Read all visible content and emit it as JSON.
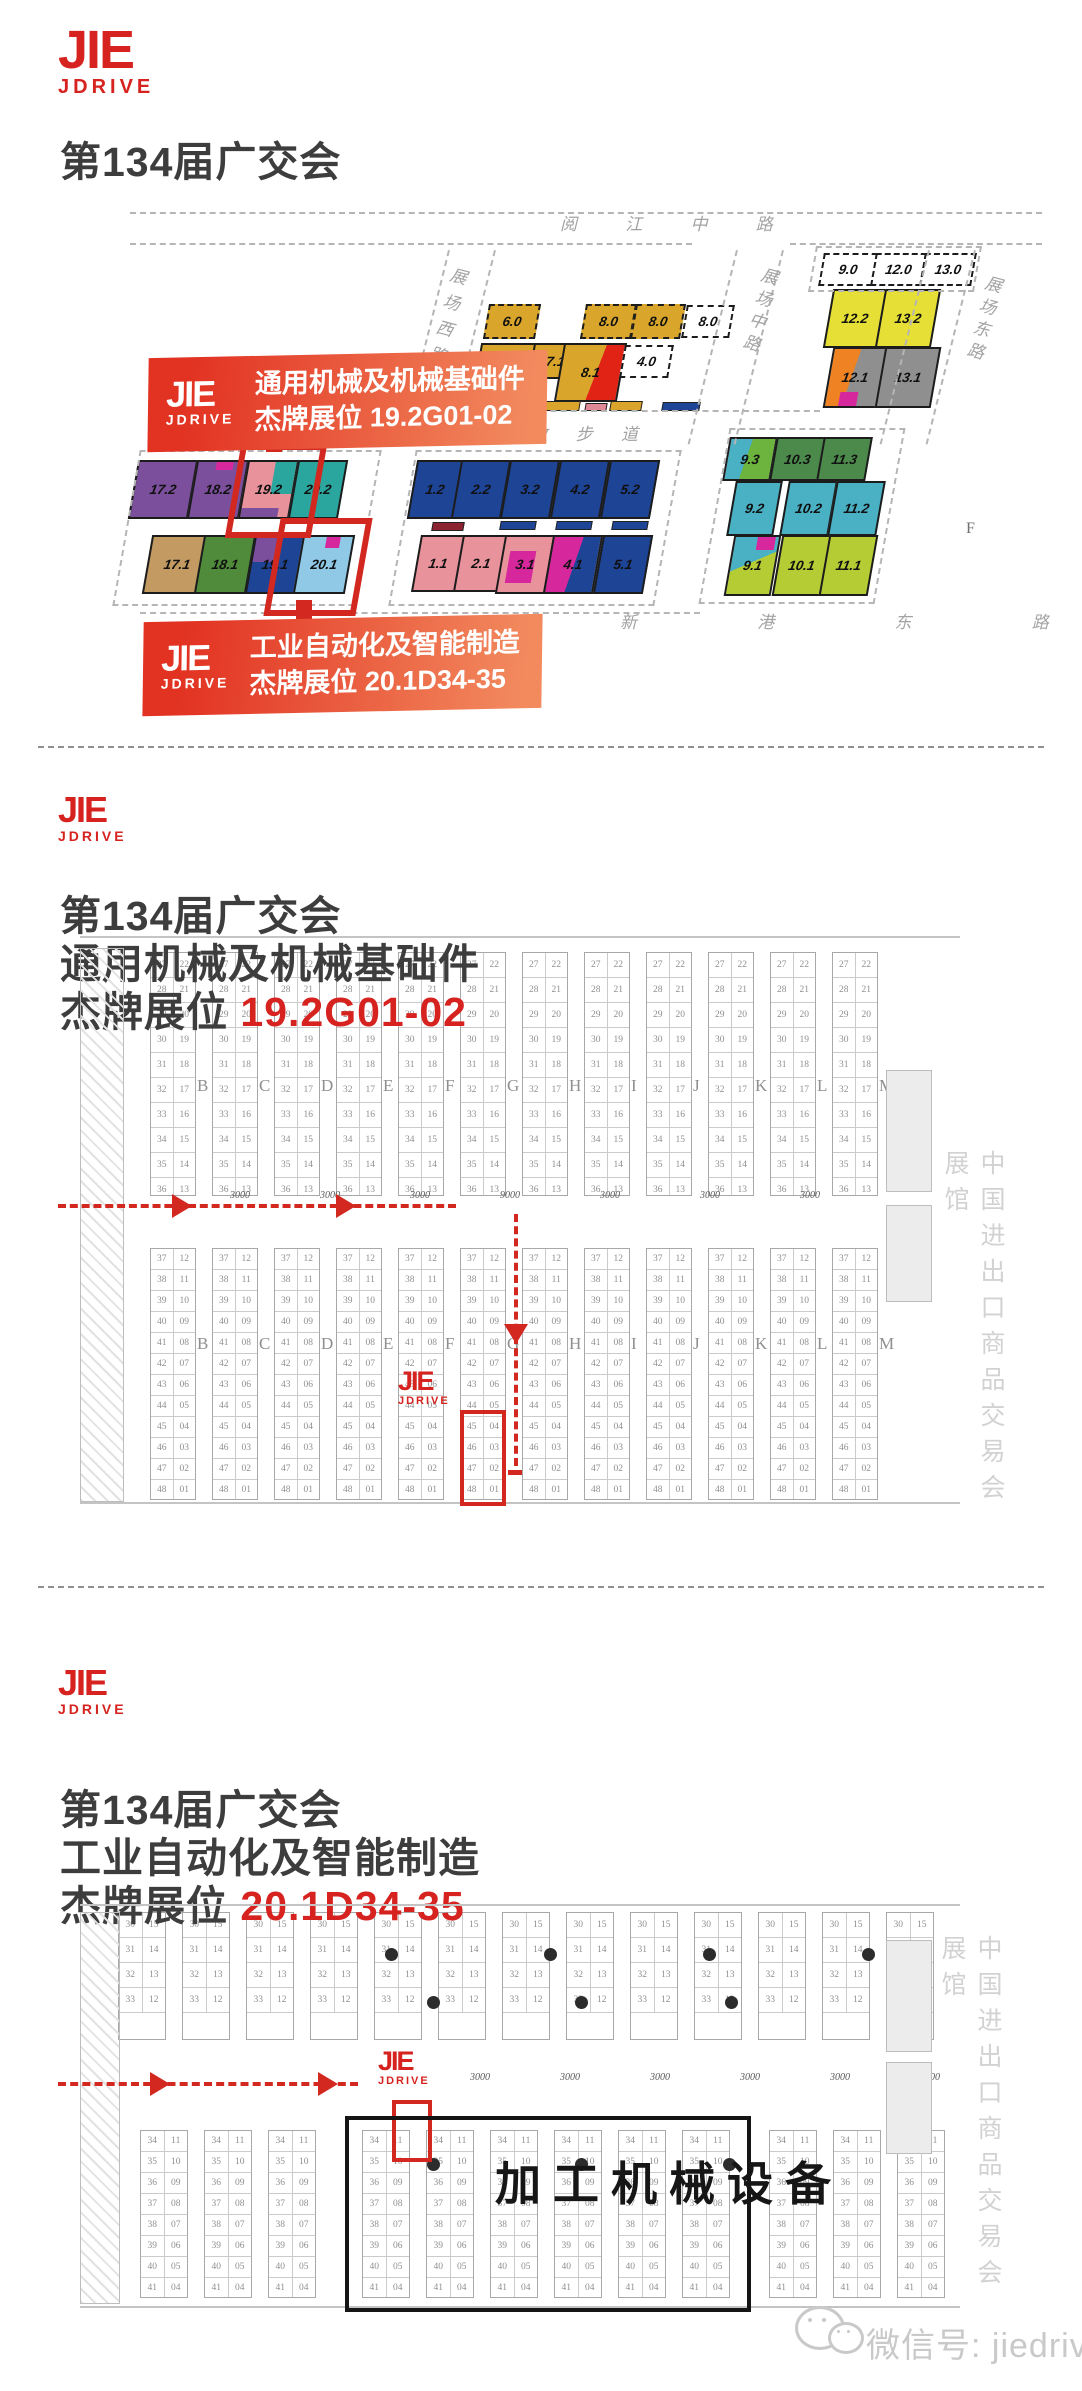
{
  "brand": {
    "name": "JIE",
    "sub": "JDRIVE",
    "red": "#d6231f"
  },
  "watermark": {
    "label": "微信号: jiedrive"
  },
  "overview": {
    "title": "第134届广交会",
    "roads": {
      "yuejiang": "阅 江 中 路",
      "west": "展场西路",
      "mid": "展场中路",
      "east": "展场东路",
      "pearl": "珠 江 散 步 道",
      "xingang": "新 港 东 路"
    },
    "marker_f": "F",
    "callouts": [
      {
        "line1": "通用机械及机械基础件",
        "line2": "杰牌展位 19.2G01-02"
      },
      {
        "line1": "工业自动化及智能制造",
        "line2": "杰牌展位 20.1D34-35"
      }
    ],
    "halls": [
      {
        "l": "6.0",
        "f": "#d9a62b",
        "x": 486,
        "y": 304,
        "w": 48,
        "h": 31,
        "dash": true
      },
      {
        "l": "8.0",
        "f": "#d9a62b",
        "x": 583,
        "y": 304,
        "w": 47,
        "h": 31,
        "dash": true
      },
      {
        "l": "8.0",
        "f": "#d9a62b",
        "x": 633,
        "y": 304,
        "w": 46,
        "h": 31,
        "dash": true
      },
      {
        "l": "8.0",
        "f": "#ffffff",
        "x": 684,
        "y": 305,
        "w": 44,
        "h": 29,
        "dash": true
      },
      {
        "l": "6.1",
        "f": "#d9a62b",
        "x": 476,
        "y": 343,
        "w": 51,
        "h": 55
      },
      {
        "l": "7.1",
        "f": "#d9a62b",
        "x": 531,
        "y": 343,
        "w": 45,
        "h": 32
      },
      {
        "l": "8.1",
        "f": "linear-gradient(102deg,#d9a62b 58%,#e02315 58%)",
        "x": 559,
        "y": 343,
        "w": 59,
        "h": 55
      },
      {
        "l": "4.0",
        "f": "#ffffff",
        "x": 622,
        "y": 345,
        "w": 45,
        "h": 29,
        "dash": true
      },
      {
        "l": "9.0",
        "f": "#ffffff",
        "x": 821,
        "y": 253,
        "w": 50,
        "h": 29,
        "dash": true
      },
      {
        "l": "12.0",
        "f": "#ffffff",
        "x": 873,
        "y": 253,
        "w": 47,
        "h": 29,
        "dash": true
      },
      {
        "l": "13.0",
        "f": "#ffffff",
        "x": 922,
        "y": 253,
        "w": 48,
        "h": 29,
        "dash": true
      },
      {
        "l": "12.2",
        "f": "#e6df36",
        "x": 828,
        "y": 289,
        "w": 50,
        "h": 55
      },
      {
        "l": "13.2",
        "f": "#e6df36",
        "x": 880,
        "y": 289,
        "w": 52,
        "h": 55
      },
      {
        "l": "12.1",
        "f": "linear-gradient(100deg,#ef8324 44%,#8f8f8f 44%)",
        "x": 828,
        "y": 347,
        "w": 50,
        "h": 57,
        "chips": [
          {
            "c": "#d6289c",
            "x": 26,
            "y": 76,
            "w": 36,
            "h": 24
          }
        ]
      },
      {
        "l": "13.1",
        "f": "#8f8f8f",
        "x": 880,
        "y": 347,
        "w": 52,
        "h": 57
      },
      {
        "l": "17.2",
        "f": "#7b4f9b",
        "x": 133,
        "y": 460,
        "w": 56,
        "h": 55
      },
      {
        "l": "18.2",
        "f": "#7b4f9b",
        "x": 192,
        "y": 460,
        "w": 48,
        "h": 55,
        "chips": [
          {
            "c": "#d6289c",
            "x": 38,
            "y": 0,
            "w": 34,
            "h": 14
          }
        ]
      },
      {
        "l": "19.2",
        "f": "#e8929c",
        "x": 243,
        "y": 460,
        "w": 47,
        "h": 55,
        "chips": [
          {
            "c": "#2ba69f",
            "x": 56,
            "y": 0,
            "w": 44,
            "h": 58
          },
          {
            "c": "#7b4f9b",
            "x": 0,
            "y": 84,
            "w": 78,
            "h": 16
          }
        ]
      },
      {
        "l": "20.2",
        "f": "#2ba69f",
        "x": 293,
        "y": 460,
        "w": 46,
        "h": 55
      },
      {
        "l": "17.1",
        "f": "#c29a62",
        "x": 147,
        "y": 535,
        "w": 56,
        "h": 55
      },
      {
        "l": "18.1",
        "f": "#4f8b3b",
        "x": 199,
        "y": 535,
        "w": 48,
        "h": 55
      },
      {
        "l": "19.1",
        "f": "#1e4496",
        "x": 250,
        "y": 535,
        "w": 46,
        "h": 55,
        "chips": [
          {
            "c": "#7b4f9b",
            "x": 0,
            "y": 0,
            "w": 52,
            "h": 46
          }
        ]
      },
      {
        "l": "20.1",
        "f": "#8fc9e6",
        "x": 298,
        "y": 535,
        "w": 48,
        "h": 55,
        "chips": [
          {
            "c": "#d6289c",
            "x": 46,
            "y": 0,
            "w": 30,
            "h": 20
          }
        ]
      },
      {
        "l": "1.2",
        "f": "#1e4496",
        "x": 412,
        "y": 460,
        "w": 42,
        "h": 55
      },
      {
        "l": "2.2",
        "f": "#1e4496",
        "x": 456,
        "y": 460,
        "w": 46,
        "h": 55
      },
      {
        "l": "3.2",
        "f": "#1e4496",
        "x": 505,
        "y": 460,
        "w": 46,
        "h": 55
      },
      {
        "l": "4.2",
        "f": "#1e4496",
        "x": 555,
        "y": 460,
        "w": 46,
        "h": 55
      },
      {
        "l": "5.2",
        "f": "#1e4496",
        "x": 605,
        "y": 460,
        "w": 46,
        "h": 55
      },
      {
        "l": "1.1",
        "f": "#e8929c",
        "x": 416,
        "y": 535,
        "w": 40,
        "h": 53
      },
      {
        "l": "2.1",
        "f": "#e8929c",
        "x": 458,
        "y": 535,
        "w": 42,
        "h": 53
      },
      {
        "l": "3.1",
        "f": "#e8929c",
        "x": 500,
        "y": 535,
        "w": 46,
        "h": 55,
        "chips": [
          {
            "c": "#d6289c",
            "x": 14,
            "y": 26,
            "w": 56,
            "h": 58
          }
        ]
      },
      {
        "l": "4.1",
        "f": "linear-gradient(100deg,#d6289c 52%,#1e4496 52%)",
        "x": 548,
        "y": 535,
        "w": 46,
        "h": 55
      },
      {
        "l": "5.1",
        "f": "#1e4496",
        "x": 598,
        "y": 535,
        "w": 46,
        "h": 55
      },
      {
        "l": "9.3",
        "f": "linear-gradient(100deg,#4ab0c3 42%,#6cb43e 42%)",
        "x": 726,
        "y": 437,
        "w": 44,
        "h": 40
      },
      {
        "l": "10.3",
        "f": "#4c8a4c",
        "x": 773,
        "y": 437,
        "w": 45,
        "h": 40
      },
      {
        "l": "11.3",
        "f": "#4c8a4c",
        "x": 820,
        "y": 437,
        "w": 45,
        "h": 40
      },
      {
        "l": "9.2",
        "f": "#4ab0c3",
        "x": 731,
        "y": 481,
        "w": 43,
        "h": 51
      },
      {
        "l": "10.2",
        "f": "#4ab0c3",
        "x": 784,
        "y": 481,
        "w": 45,
        "h": 51
      },
      {
        "l": "11.2",
        "f": "#4ab0c3",
        "x": 832,
        "y": 481,
        "w": 45,
        "h": 51
      },
      {
        "l": "9.1",
        "f": "linear-gradient(155deg,#4ab0c3 45%,#b6cc34 45%)",
        "x": 729,
        "y": 535,
        "w": 43,
        "h": 57,
        "chips": [
          {
            "c": "#d6289c",
            "x": 52,
            "y": 0,
            "w": 42,
            "h": 22
          }
        ]
      },
      {
        "l": "10.1",
        "f": "#b6cc34",
        "x": 777,
        "y": 535,
        "w": 45,
        "h": 57
      },
      {
        "l": "11.1",
        "f": "#b6cc34",
        "x": 824,
        "y": 535,
        "w": 45,
        "h": 57
      }
    ]
  },
  "section2": {
    "line1": "第134届广交会",
    "line2": "通用机械及机械基础件",
    "booth_prefix": "杰牌展位 ",
    "booth_no": "19.2G01-02",
    "plan": {
      "letters": [
        "B",
        "C",
        "D",
        "E",
        "F",
        "G",
        "H",
        "I",
        "J",
        "K",
        "L",
        "M"
      ],
      "rows_top": [
        [
          "27",
          "22"
        ],
        [
          "28",
          "21"
        ],
        [
          "29",
          "20"
        ],
        [
          "30",
          "19"
        ],
        [
          "31",
          "18"
        ],
        [
          "32",
          "17"
        ],
        [
          "33",
          "16"
        ],
        [
          "34",
          "15"
        ],
        [
          "35",
          "14"
        ],
        [
          "36",
          "13"
        ]
      ],
      "rows_bottom": [
        [
          "37",
          "12"
        ],
        [
          "38",
          "11"
        ],
        [
          "39",
          "10"
        ],
        [
          "40",
          "09"
        ],
        [
          "41",
          "08"
        ],
        [
          "42",
          "07"
        ],
        [
          "43",
          "06"
        ],
        [
          "44",
          "05"
        ],
        [
          "45",
          "04"
        ],
        [
          "46",
          "03"
        ],
        [
          "47",
          "02"
        ],
        [
          "48",
          "01"
        ]
      ],
      "dims": [
        "3000",
        "3000",
        "3000",
        "9000",
        "3000",
        "3000",
        "3000"
      ],
      "side_text": "中国进出口商品交易会展馆"
    }
  },
  "section3": {
    "line1": "第134届广交会",
    "line2": "工业自动化及智能制造",
    "booth_prefix": "杰牌展位 ",
    "booth_no": "20.1D34-35",
    "plan": {
      "rows_top": [
        [
          "30",
          "15"
        ],
        [
          "31",
          "14"
        ],
        [
          "32",
          "13"
        ],
        [
          "33",
          "12"
        ]
      ],
      "rows_bottom": [
        [
          "34",
          "11"
        ],
        [
          "35",
          "10"
        ],
        [
          "36",
          "09"
        ],
        [
          "37",
          "08"
        ],
        [
          "38",
          "07"
        ],
        [
          "39",
          "06"
        ],
        [
          "40",
          "05"
        ],
        [
          "41",
          "04"
        ]
      ],
      "dims": [
        "3000",
        "3000",
        "3000",
        "3000",
        "3000",
        "3000"
      ],
      "side_text": "中国进出口商品交易会展馆",
      "big_label": "加工机械设备"
    }
  }
}
